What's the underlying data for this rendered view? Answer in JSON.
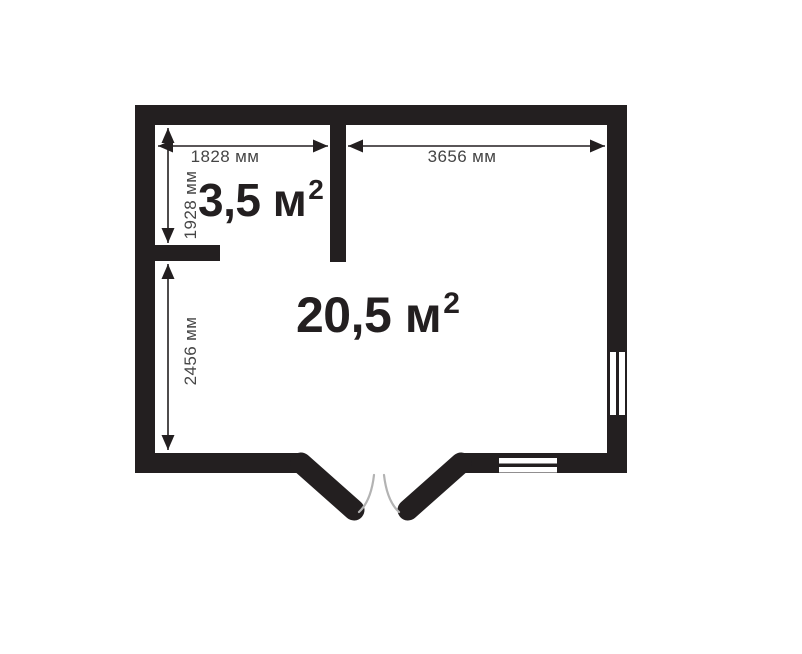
{
  "floor_plan": {
    "rooms": {
      "small": {
        "area": "3,5 м",
        "exponent": "2"
      },
      "large": {
        "area": "20,5 м",
        "exponent": "2"
      }
    },
    "dimensions": {
      "small_room_width": "1828 мм",
      "main_room_width": "3656 мм",
      "small_room_height": "1928 мм",
      "main_room_height": "2456 мм"
    },
    "colors": {
      "wall": "#231f20",
      "dimension_text": "#454545",
      "door_swing": "#b3b3b3",
      "background": "#ffffff"
    }
  }
}
